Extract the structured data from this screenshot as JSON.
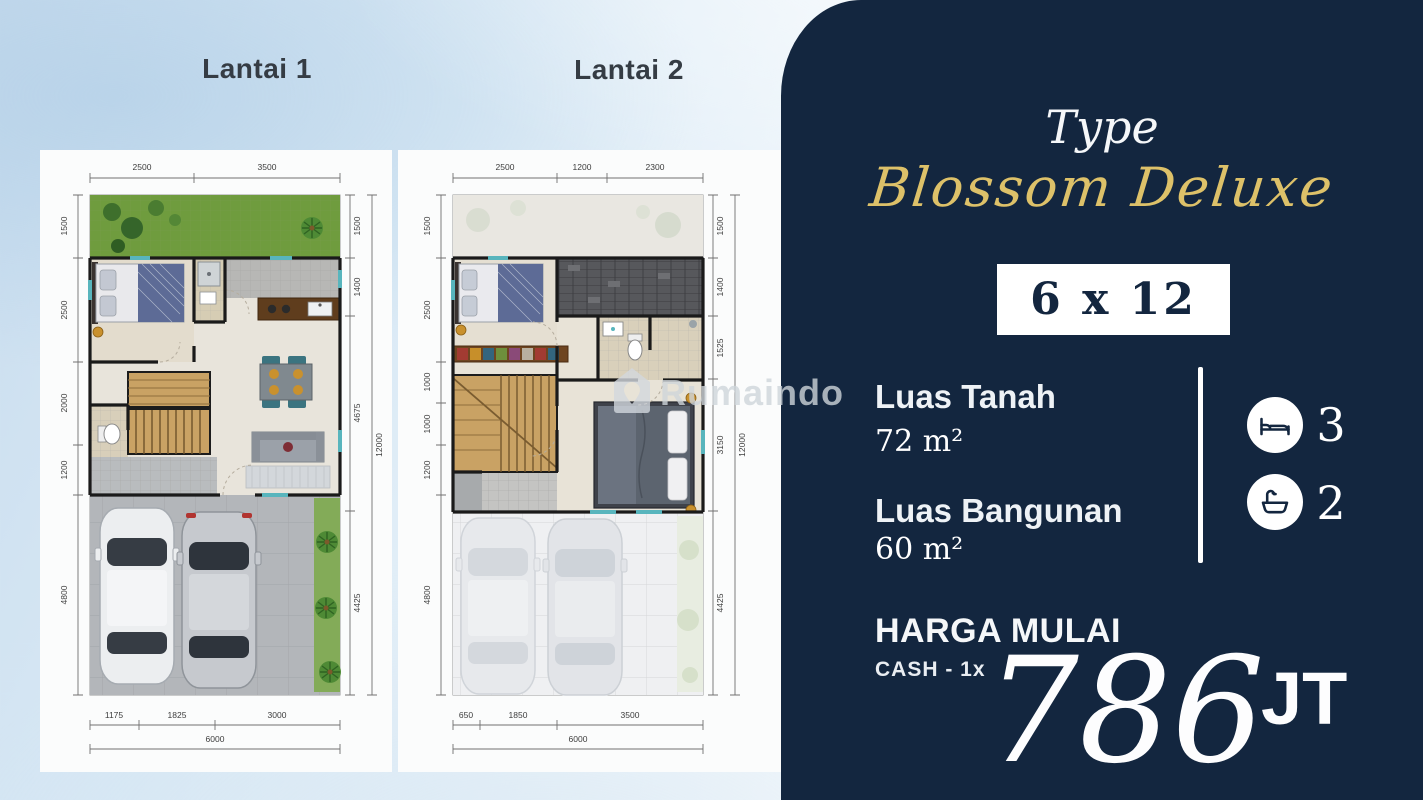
{
  "plans": [
    {
      "title": "Lantai 1",
      "dims": {
        "top": [
          "2500",
          "3500"
        ],
        "left": [
          "1500",
          "2500",
          "2000",
          "1200",
          "4800"
        ],
        "right": [
          "1500",
          "1400",
          "4675",
          "4425"
        ],
        "right_total": "12000",
        "bottom": [
          "1175",
          "1825",
          "3000"
        ],
        "bottom_total": "6000"
      }
    },
    {
      "title": "Lantai 2",
      "dims": {
        "top": [
          "2500",
          "1200",
          "2300"
        ],
        "left": [
          "1500",
          "2500",
          "1000",
          "1000",
          "1200",
          "4800"
        ],
        "right": [
          "1500",
          "1400",
          "1525",
          "3150",
          "4425"
        ],
        "right_total": "12000",
        "bottom": [
          "650",
          "1850",
          "3500"
        ],
        "bottom_total": "6000"
      }
    }
  ],
  "watermark": {
    "brand": "Rumaindo"
  },
  "panel": {
    "type_label": "Type",
    "type_name": "Blossom Deluxe",
    "size": "6 x 12",
    "specs": [
      {
        "label": "Luas Tanah",
        "value": "72 m²"
      },
      {
        "label": "Luas Bangunan",
        "value": "60 m²"
      }
    ],
    "features": [
      {
        "icon": "bed-icon",
        "count": "3"
      },
      {
        "icon": "bathtub-icon",
        "count": "2"
      }
    ],
    "price_label": "HARGA MULAI",
    "payment_label": "CASH - 1x",
    "price_value": "786",
    "price_unit": "JT"
  },
  "colors": {
    "panel_bg": "#13263f",
    "accent_gold": "#ddc169",
    "title_text": "#353c44",
    "size_box_bg": "#ffffff"
  }
}
